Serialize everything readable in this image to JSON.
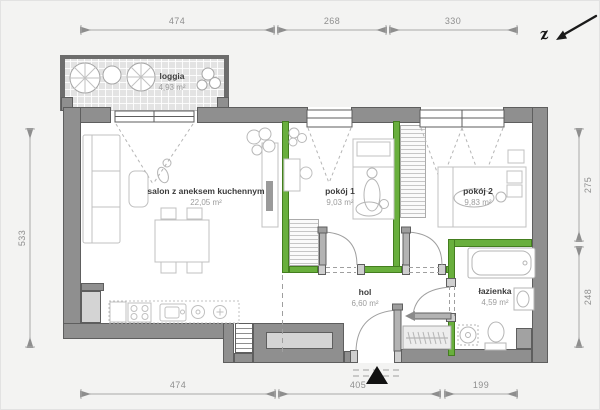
{
  "plan": {
    "north_label": "z",
    "rooms": [
      {
        "name": "loggia",
        "area": "4,93 m²"
      },
      {
        "name": "salon z aneksem kuchennym",
        "area": "22,05 m²"
      },
      {
        "name": "pokój 1",
        "area": "9,03 m²"
      },
      {
        "name": "pokój 2",
        "area": "9,83 m²"
      },
      {
        "name": "hol",
        "area": "6,60 m²"
      },
      {
        "name": "łazienka",
        "area": "4,59 m²"
      }
    ],
    "dimensions": {
      "top": [
        "474",
        "268",
        "330"
      ],
      "bottom": [
        "474",
        "405",
        "199"
      ],
      "left": [
        "533"
      ],
      "right": [
        "275",
        "248"
      ]
    },
    "colors": {
      "wall": "#8f8f8f",
      "accent_wall": "#69af3d",
      "dimension": "#8e8e8e"
    }
  }
}
